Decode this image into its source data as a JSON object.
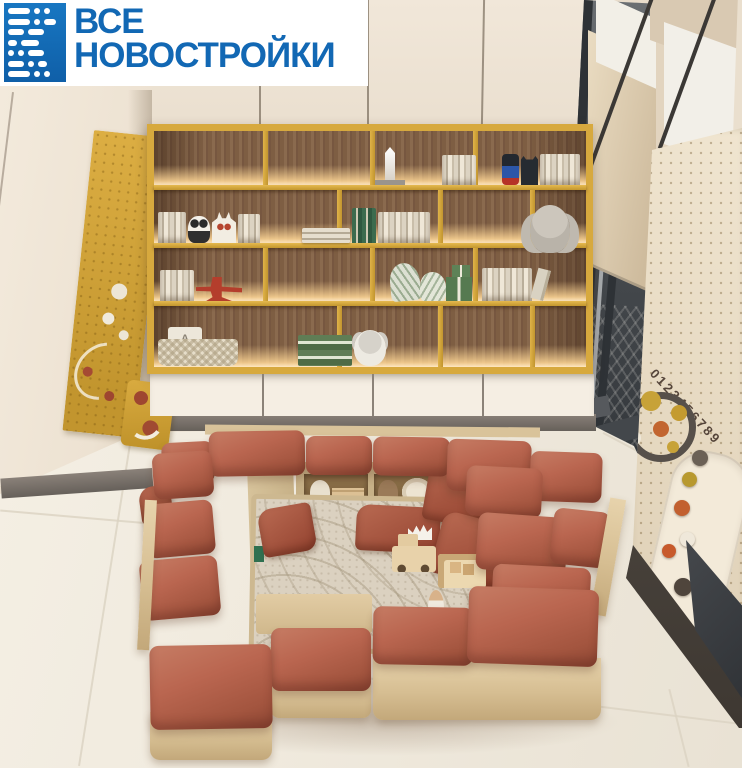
{
  "brand": {
    "line1": "ВСЕ",
    "line2": "НОВОСТРОЙКИ"
  },
  "right_panel": {
    "numbers": "0123456789"
  },
  "shelf": {
    "letter_block": "A"
  },
  "palette": {
    "wall": "#E8DCCB",
    "cabinet": "#F0E6D8",
    "accent_yellow": "#D7A93E",
    "shelf_wood": "#7B5B41",
    "shelf_glow": "#FFD9A0",
    "drawer": "#F4EDE2",
    "baseboard": "#77706A",
    "floor": "#F1EBDF",
    "cushion": "#BA6650",
    "cushion_dark": "#9D503C",
    "base_wood": "#E2CCA5",
    "rug": "#DBD1C0",
    "pillow": "#A14F3B",
    "window_frame": "#3C4043",
    "panel_cream": "#EBDFC9",
    "brand_blue": "#1268B4",
    "logo_bg": "#FFFFFF"
  }
}
